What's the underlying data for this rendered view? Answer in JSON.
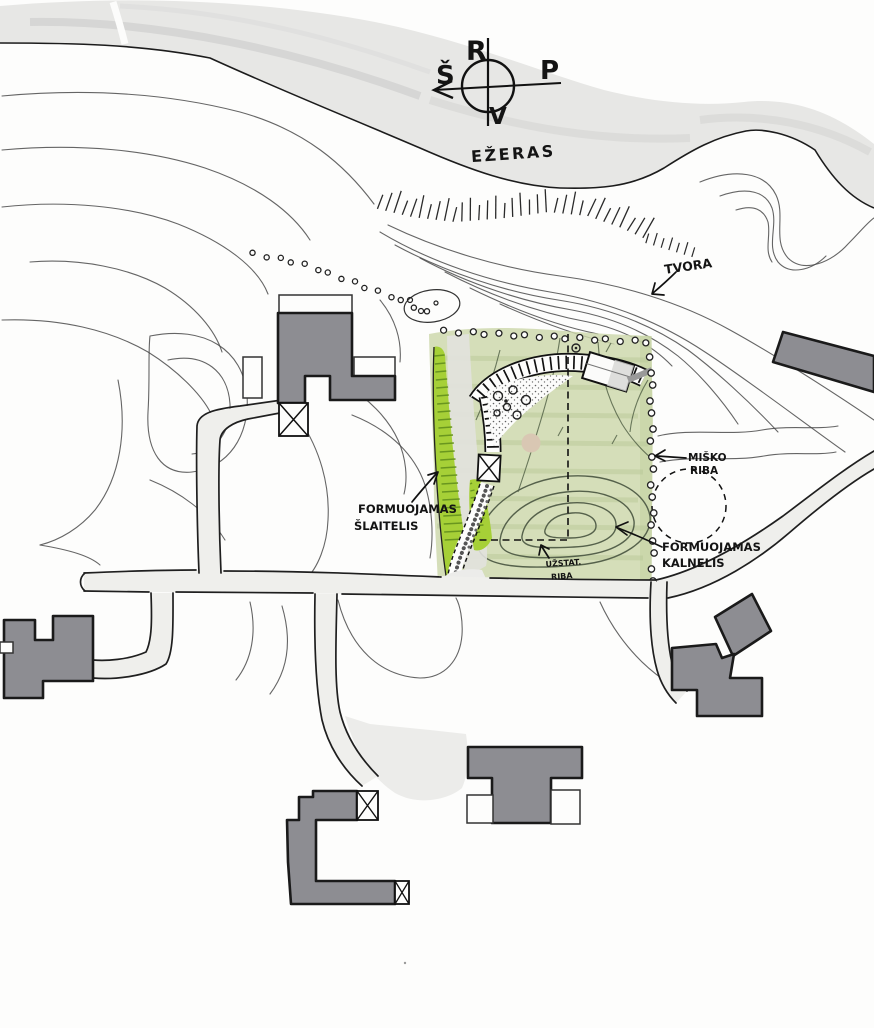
{
  "compass": {
    "top": "R",
    "right": "P",
    "bottom": "V",
    "left": "Š"
  },
  "labels": {
    "lake": "EŽERAS",
    "fence": "TVORA",
    "forest_boundary": [
      "MIŠKO",
      "RIBA"
    ],
    "formed_slope": [
      "FORMUOJAMAS",
      "ŠLAITELIS"
    ],
    "formed_hill": [
      "FORMUOJAMAS",
      "KALNELIS"
    ],
    "development_boundary": [
      "UŽSTAT.",
      "RIBA"
    ]
  },
  "colors": {
    "paper": "#fdfdfc",
    "lake_gray": "#e7e7e5",
    "site_green": "#ccd7aa",
    "bright_green": "#a6d037",
    "hatch_green": "#69961f",
    "building_gray": "#8d8d92",
    "road_gray": "#efefec",
    "ink": "#1a1a1a",
    "contour_gray": "#4a4a4a",
    "sand": "#d9c7b3"
  }
}
